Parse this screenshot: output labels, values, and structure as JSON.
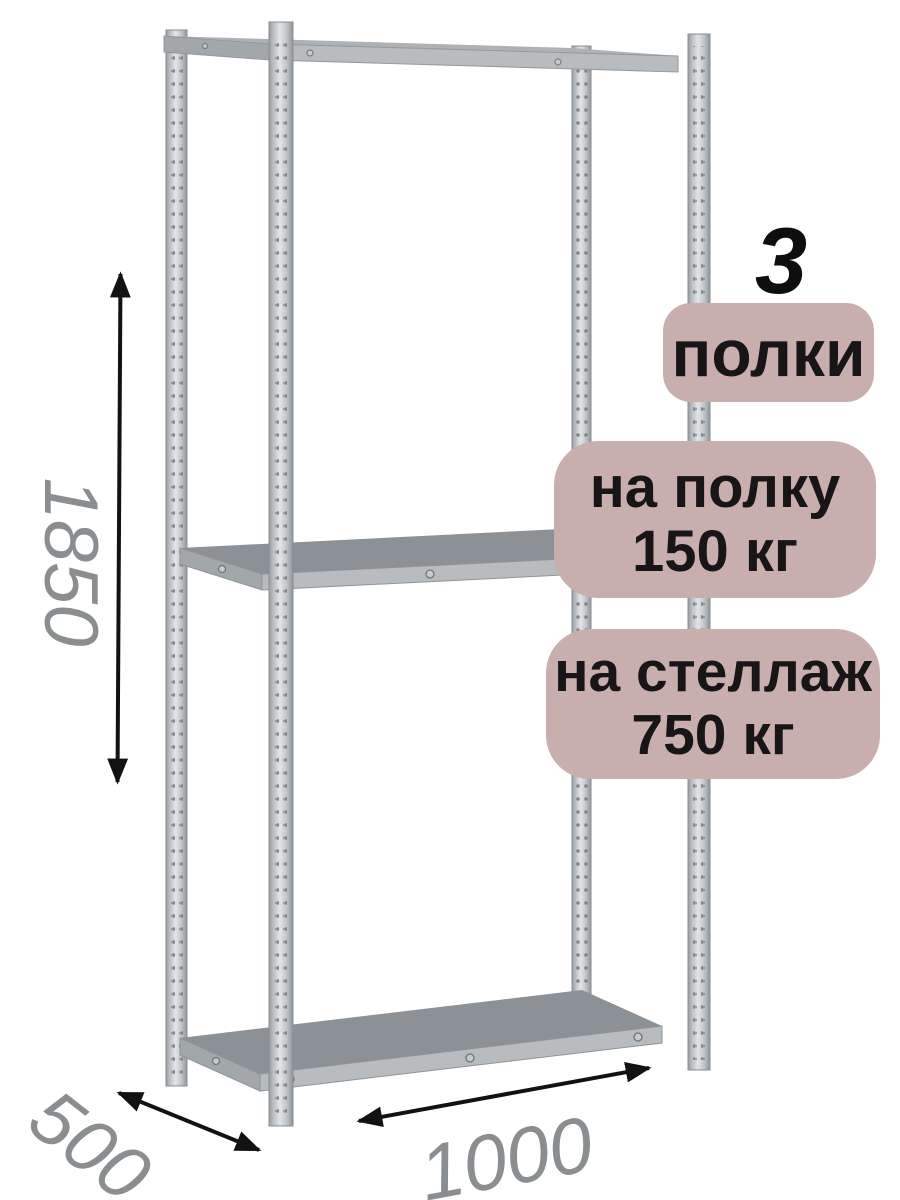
{
  "product_badges": {
    "shelf_count": "3",
    "shelf_count_label": "полки",
    "per_shelf_load": {
      "line1": "на полку",
      "line2": "150 кг"
    },
    "per_rack_load": {
      "line1": "на стеллаж",
      "line2": "750 кг"
    }
  },
  "dimensions": {
    "height": "1850",
    "depth": "500",
    "width": "1000"
  },
  "colors": {
    "background": "#ffffff",
    "badge_background": "#c9aeae",
    "badge_text": "#171515",
    "dimension_label": "#8a8e90",
    "arrow": "#121212",
    "metal_highlight": "#e2e5e7",
    "metal_base": "#b9bec2",
    "metal_shadow": "#8f959a",
    "shelf_surface": "#8c9195"
  }
}
